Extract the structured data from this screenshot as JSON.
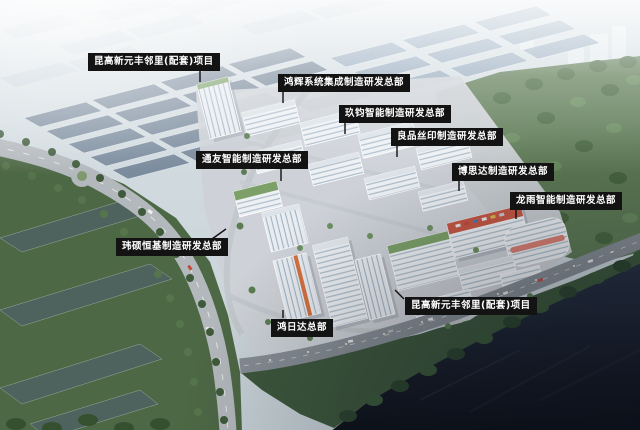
{
  "labels": [
    {
      "text": "昆高新元丰邻里(配套)项目"
    },
    {
      "text": "鸿辉系统集成制造研发总部"
    },
    {
      "text": "玖钧智能制造研发总部"
    },
    {
      "text": "良品丝印制造研发总部"
    },
    {
      "text": "通友智能制造研发总部"
    },
    {
      "text": "博思达制造研发总部"
    },
    {
      "text": "龙雨智能制造研发总部"
    },
    {
      "text": "玮硕恒基制造研发总部"
    },
    {
      "text": "鸿日达总部"
    },
    {
      "text": "昆高新元丰邻里(配套)项目"
    }
  ],
  "colors": {
    "label_bg": "#131313",
    "label_text": "#ffffff",
    "water": "#10151f",
    "foliage": "#4d6845",
    "roof_slate": "#76879a",
    "accent_red": "#c65744",
    "accent_orange": "#d4713f"
  }
}
